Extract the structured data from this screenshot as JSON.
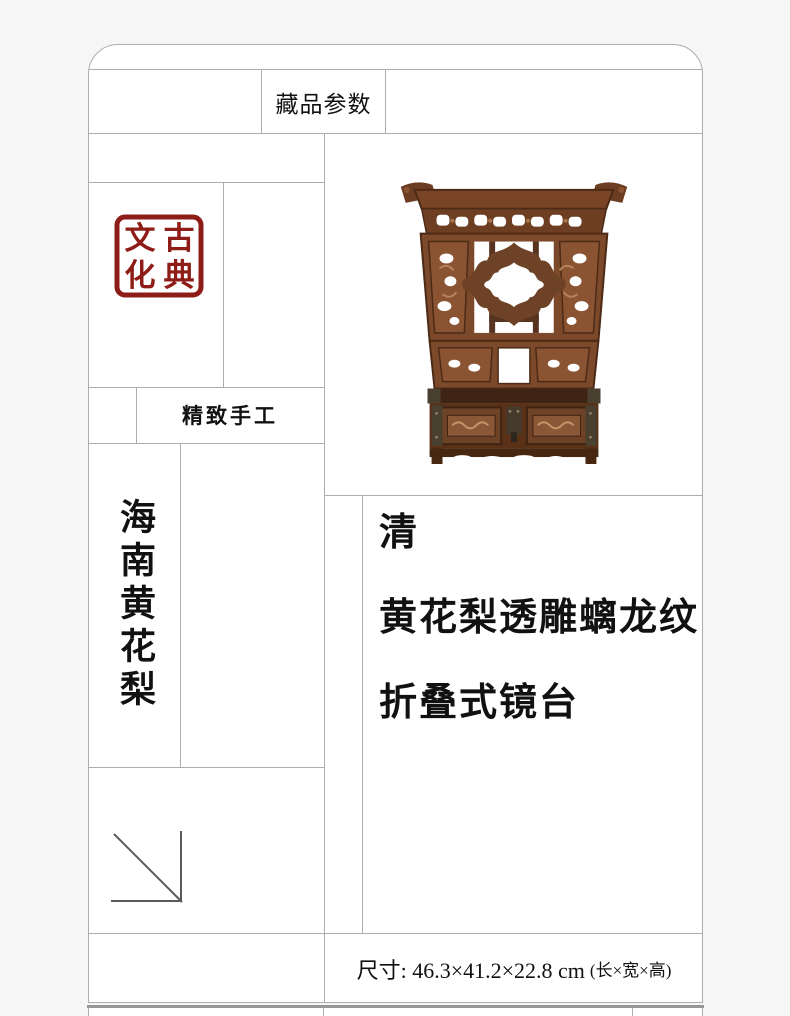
{
  "theme": {
    "page_bg": "#f6f6f6",
    "card_bg": "#ffffff",
    "line": "#adadad",
    "text": "#111111",
    "seal_red": "#8e1d18",
    "wood_mid": "#7c4a2a",
    "wood_dark": "#452616",
    "wood_light": "#96603a",
    "metal": "#49402f"
  },
  "header": {
    "title": "藏品参数"
  },
  "seal": {
    "name": "古典文化",
    "top_left": "文",
    "top_right": "古",
    "bottom_left": "化",
    "bottom_right": "典"
  },
  "badges": {
    "handcraft": "精致手工",
    "material": "海南黄花梨"
  },
  "product": {
    "dynasty": "清",
    "title_line1": "黄花梨透雕螭龙纹",
    "title_line2": "折叠式镜台"
  },
  "specs": {
    "dimensions": "尺寸: 46.3×41.2×22.8 cm",
    "note": "(长×宽×高)"
  }
}
